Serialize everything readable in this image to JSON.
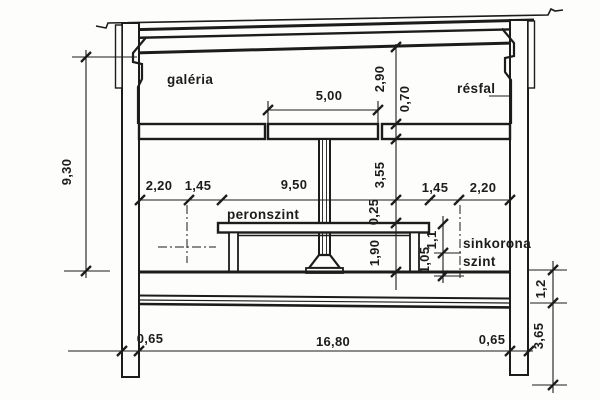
{
  "drawing": {
    "labels": {
      "galeria": "galéria",
      "resfal": "résfal",
      "peronszint": "peronszint",
      "sinkorona": "sinkorona",
      "szint": "szint"
    },
    "dims": {
      "total_height": "9,30",
      "opening_width": "5,00",
      "gallery_height": "2,90",
      "slab_thickness": "0,70",
      "wall_to_axis_left": "2,20",
      "axis_to_platform_left": "1,45",
      "platform_width": "9,50",
      "mid_height": "3,55",
      "platform_edge_offset": "0,25",
      "lower_height": "1,90",
      "platform_to_axis_right": "1,45",
      "axis_to_wall_right": "2,20",
      "platform_above_rail": "1,1",
      "rail_above_base": "1,05",
      "base_slab_thickness": "1,2",
      "wall_embedment": "3,65",
      "wall_width_left": "0,65",
      "interior_width": "16,80",
      "wall_width_right": "0,65"
    },
    "colors": {
      "ink": "#1c1c1c",
      "paper": "#fdfdfb"
    }
  }
}
